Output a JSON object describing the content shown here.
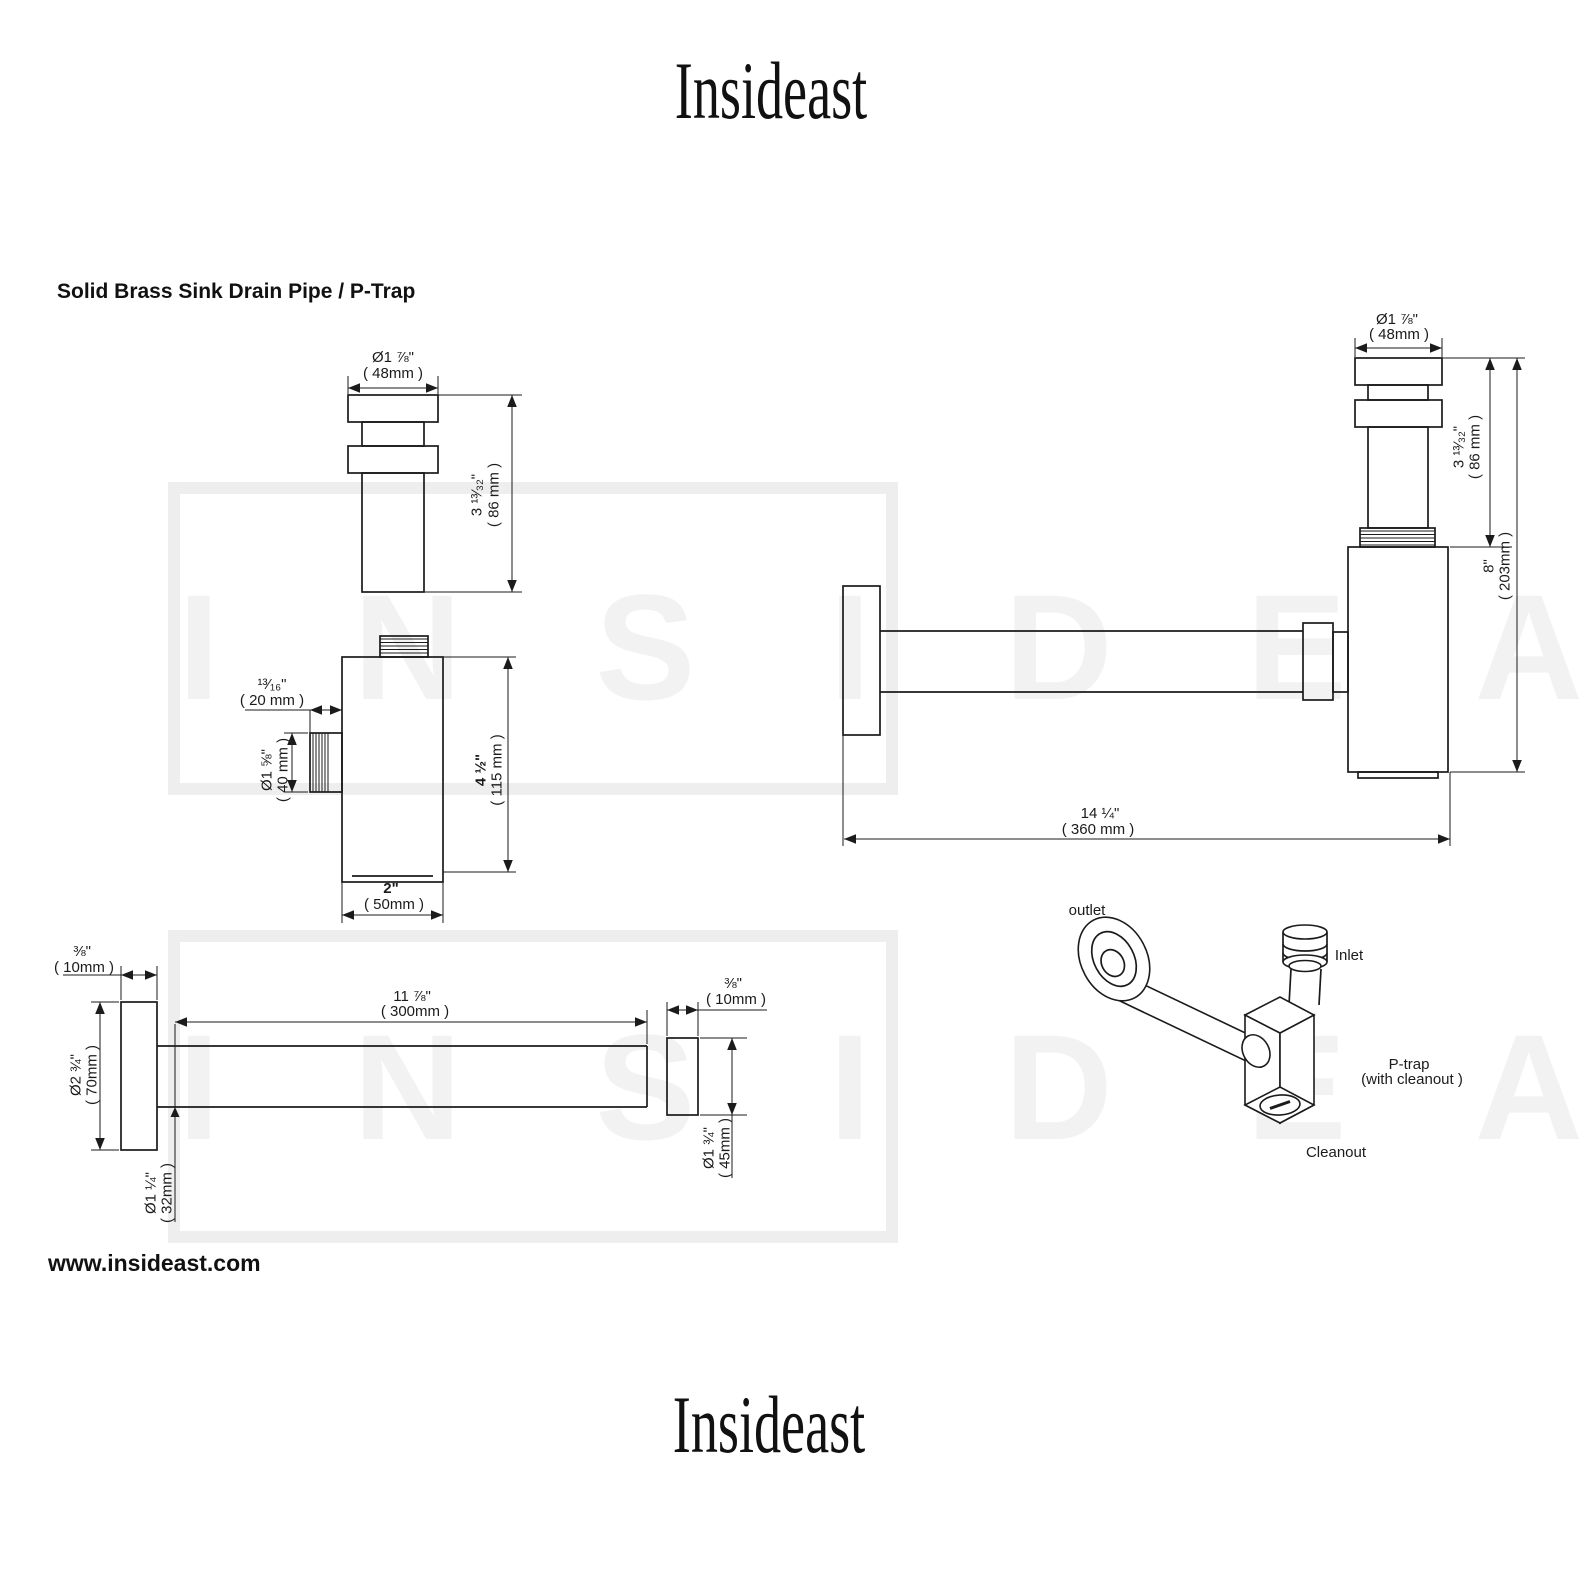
{
  "page": {
    "title": "Solid Brass Sink Drain Pipe / P-Trap",
    "logo_top": "Insideast",
    "logo_bottom": "Insideast",
    "website": "www.insideast.com",
    "watermark_text": "I N S I D E A S T"
  },
  "dims": {
    "tailpiece": {
      "dia_in": "Ø1 ⅞\"",
      "dia_mm": "( 48mm )",
      "len_in": "3 ¹³⁄₃₂\"",
      "len_mm": "( 86 mm )"
    },
    "trap_body": {
      "offset_in": "¹³⁄₁₆\"",
      "offset_mm": "( 20 mm )",
      "outlet_in": "Ø1 ⅝\"",
      "outlet_mm": "( 40 mm )",
      "height_in": "4 ½\"",
      "height_mm": "( 115 mm )",
      "width_in": "2\"",
      "width_mm": "( 50mm )"
    },
    "assembly": {
      "dia_in": "Ø1 ⅞\"",
      "dia_mm": "( 48mm )",
      "tail_in": "3 ¹³⁄₃₂\"",
      "tail_mm": "( 86 mm )",
      "height_in": "8\"",
      "height_mm": "( 203mm )",
      "reach_in": "14 ¼\"",
      "reach_mm": "( 360 mm )"
    },
    "wall_tube": {
      "flange_in": "⅜\"",
      "flange_mm": "( 10mm )",
      "flange_dia_in": "Ø2 ¾\"",
      "flange_dia_mm": "( 70mm )",
      "len_in": "11 ⅞\"",
      "len_mm": "( 300mm )",
      "dia_in": "Ø1 ¼\"",
      "dia_mm": "( 32mm )",
      "sleeve_in": "⅜\"",
      "sleeve_mm": "( 10mm )",
      "sleeve_dia_in": "Ø1 ¾\"",
      "sleeve_dia_mm": "( 45mm )"
    },
    "iso": {
      "outlet": "outlet",
      "inlet": "Inlet",
      "ptrap": "P-trap",
      "ptrap2": "(with cleanout )",
      "cleanout": "Cleanout"
    }
  }
}
